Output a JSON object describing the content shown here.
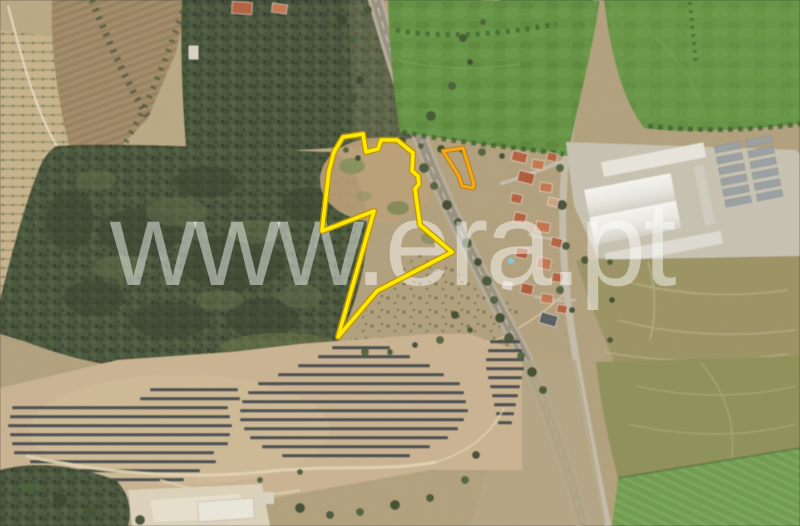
{
  "map": {
    "type": "satellite-aerial-view",
    "watermark": {
      "text": "www.era.pt",
      "color": "#ffffff",
      "opacity": 0.47
    },
    "parcels": {
      "main": {
        "stroke": "#ffe900",
        "halo": "#bd9400",
        "points": [
          [
            343,
            137
          ],
          [
            363,
            134
          ],
          [
            366,
            152
          ],
          [
            378,
            149
          ],
          [
            381,
            140
          ],
          [
            397,
            140
          ],
          [
            413,
            153
          ],
          [
            412,
            171
          ],
          [
            418,
            176
          ],
          [
            419,
            184
          ],
          [
            415,
            189
          ],
          [
            420,
            225
          ],
          [
            452,
            252
          ],
          [
            377,
            291
          ],
          [
            338,
            337
          ],
          [
            374,
            211
          ],
          [
            333,
            227
          ],
          [
            322,
            231
          ],
          [
            326,
            196
          ],
          [
            329,
            171
          ],
          [
            334,
            152
          ]
        ]
      },
      "small": {
        "stroke": "#f4a81d",
        "halo": "#b97b00",
        "points": [
          [
            443,
            151
          ],
          [
            463,
            148
          ],
          [
            474,
            184
          ],
          [
            473,
            188
          ],
          [
            462,
            186
          ],
          [
            459,
            176
          ]
        ]
      }
    },
    "palette": {
      "terrain_tan": "#b2a07c",
      "forest_green": "#47543a",
      "field_green": "#629140",
      "solar_panel_gray": "#3f454b",
      "roof_terracotta": "#b5603c",
      "railway_gray": "#98917f",
      "warehouse_white": "#ecebe4"
    }
  }
}
